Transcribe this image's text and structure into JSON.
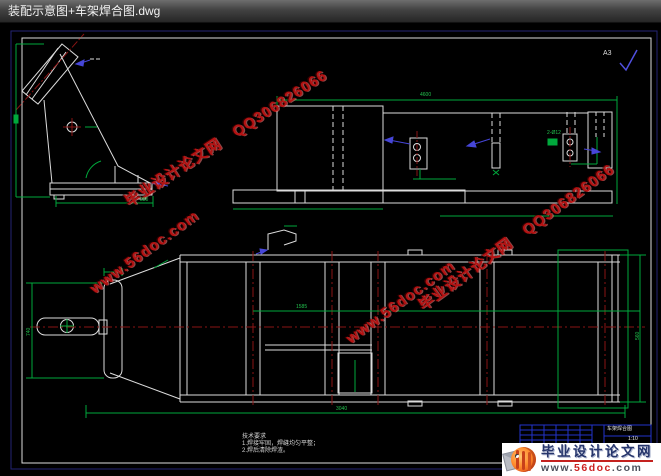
{
  "window": {
    "title": "装配示意图+车架焊合图.dwg"
  },
  "sheet": {
    "size_mark": "A3"
  },
  "watermarks": {
    "line1": "毕业设计论文网　QQ306826066",
    "line2": "www.56doc.com"
  },
  "notes": {
    "title": "技术要求",
    "item1": "1.焊接牢固，焊缝均匀平整；",
    "item2": "2.焊后清除焊渣。"
  },
  "title_block": {
    "drawing_name": "车架焊合图",
    "scale": "1:10"
  },
  "dims": {
    "top_overall": "4600",
    "mid_span": "1585",
    "bottom_overall": "3040",
    "bracket_base": "380",
    "left_width": "740",
    "right_width": "560",
    "holes": "2-Ø12"
  },
  "logo": {
    "site_name": "毕业设计论文网",
    "url_prefix": "www.",
    "url_domain": "56doc",
    "url_suffix": ".com"
  },
  "colors": {
    "line_white": "#dcdcdc",
    "dim_green": "#00a83c",
    "center_red": "#8a1414",
    "leader_blue": "#4646d8",
    "border_navy": "#232375",
    "titleblock_blue": "#2233cc",
    "watermark_red": "#b51212"
  }
}
